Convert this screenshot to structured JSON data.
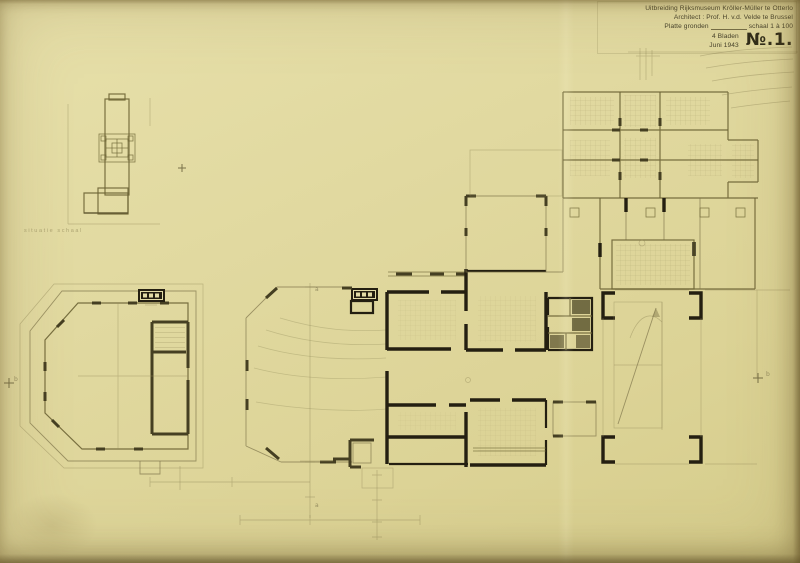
{
  "title_block": {
    "project": "Uitbreiding Rijksmuseum Kröller-Müller te Otterlo",
    "architect": "Architect : Prof. H. v.d. Velde te Brussel",
    "drawing_label": "Platte gronden",
    "scale": "schaal 1 à 100",
    "sheets": "4 Bladen",
    "date": "Juni 1943",
    "sheet_number": "№.1."
  },
  "site_plan": {
    "caption": "situatie  schaal"
  },
  "section_markers": {
    "a": "a",
    "b": "b"
  },
  "colors": {
    "paper": "#e0d89e",
    "ink": "#241f11",
    "olive_line": "#6d6435",
    "pencil": "#958c5c",
    "edge_shadow": "#5e4e24"
  }
}
